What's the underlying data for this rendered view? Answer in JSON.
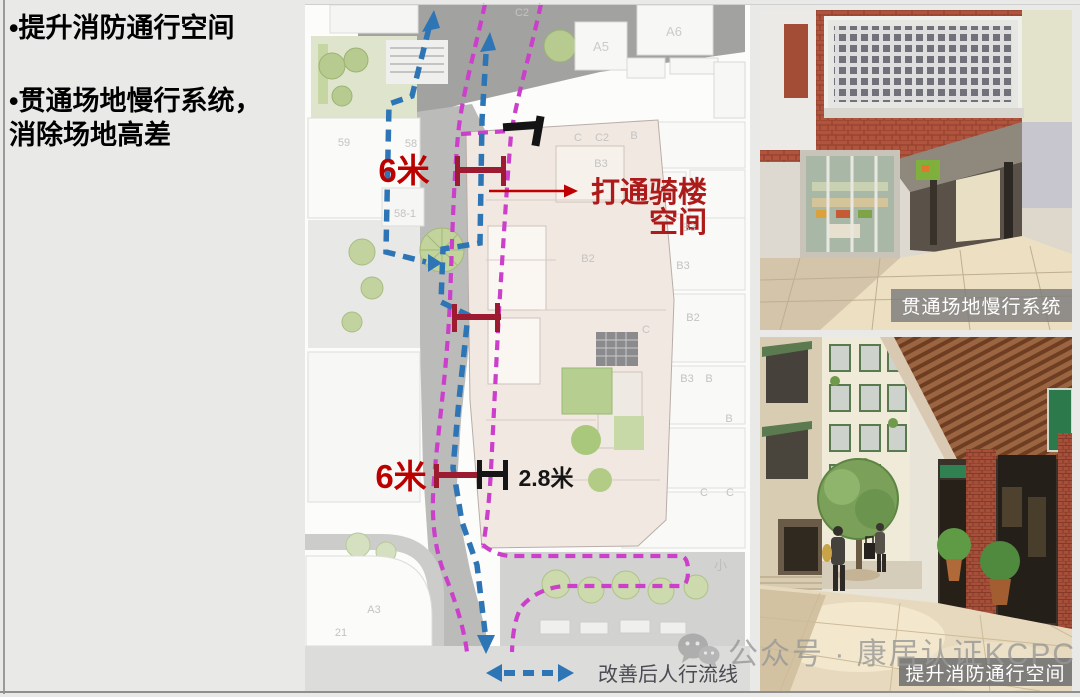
{
  "panel": {
    "bullet1": "•提升消防通行空间",
    "bullet2_line1": "•贯通场地慢行系统，",
    "bullet2_line2": "消除场地高差"
  },
  "map": {
    "measure_top": "6米",
    "measure_bottom": "6米",
    "measure_arcade": "2.8米",
    "annotation_line1": "打通骑楼",
    "annotation_line2": "空间",
    "legend_label": "改善后人行流线",
    "street_label": "小",
    "building_labels": [
      "C2",
      "A5",
      "A6",
      "59",
      "58",
      "C",
      "C2",
      "B",
      "B3",
      "B2",
      "B3",
      "B3",
      "B2",
      "C",
      "B3",
      "B",
      "B",
      "58-1",
      "C",
      "C",
      "A3",
      "21"
    ]
  },
  "photos": {
    "top_caption": "贯通场地慢行系统",
    "bottom_caption": "提升消防通行空间"
  },
  "watermark": {
    "icon": "wechat-icon",
    "text": "公众号 · 康居认证KCPC"
  },
  "colors": {
    "flow_blue": "#2E75B6",
    "flow_magenta": "#CB3FCB",
    "measure_dark_red": "#9C1B30",
    "annotation_red": "#AD1A1A",
    "dimension_red": "#BB0000",
    "slide_bg": "#E9E9E7"
  }
}
